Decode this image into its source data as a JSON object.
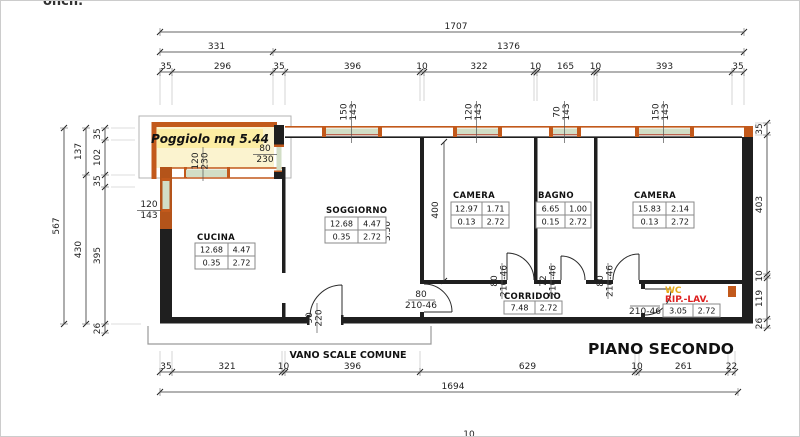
{
  "meta": {
    "clipped_top_text": "onch.",
    "clipped_bottom_text": "10"
  },
  "titles": {
    "balcony": "Poggiolo mq 5.44",
    "stairwell": "VANO SCALE COMUNE",
    "floor": "PIANO SECONDO"
  },
  "dims": {
    "top_total": "1707",
    "top_mid": [
      "331",
      "1376"
    ],
    "top_row3": [
      "35",
      "296",
      "35",
      "396",
      "10",
      "322",
      "10",
      "165",
      "10",
      "393",
      "35"
    ],
    "bottom_row": [
      "35",
      "321",
      "10",
      "396",
      "629",
      "10",
      "261",
      "22"
    ],
    "bottom_total": "1694",
    "left_total": "567",
    "left_mid": [
      "137",
      "430"
    ],
    "left_inner": [
      "35",
      "102",
      "35",
      "395",
      "26"
    ],
    "right": [
      "35",
      "403",
      "10",
      "119",
      "26"
    ],
    "camera_depth": "400",
    "soggiorno_side": "3.50"
  },
  "rooms": {
    "cucina": {
      "name": "CUCINA",
      "table": [
        [
          "12.68",
          "4.47"
        ],
        [
          "0.35",
          "2.72"
        ]
      ]
    },
    "soggiorno": {
      "name": "SOGGIORNO",
      "table": [
        [
          "12.68",
          "4.47"
        ],
        [
          "0.35",
          "2.72"
        ]
      ]
    },
    "camera1": {
      "name": "CAMERA",
      "table": [
        [
          "12.97",
          "1.71"
        ],
        [
          "0.13",
          "2.72"
        ]
      ]
    },
    "bagno": {
      "name": "BAGNO",
      "table": [
        [
          "6.65",
          "1.00"
        ],
        [
          "0.15",
          "2.72"
        ]
      ]
    },
    "camera2": {
      "name": "CAMERA",
      "table": [
        [
          "15.83",
          "2.14"
        ],
        [
          "0.13",
          "2.72"
        ]
      ]
    },
    "corridoio": {
      "name": "CORRIDOIO",
      "table": [
        [
          "7.48",
          "2.72"
        ]
      ]
    },
    "wc": {
      "name_line1": "WC",
      "name_line2": "RIP.-LAV.",
      "table": [
        [
          "3.05",
          "2.72"
        ]
      ]
    }
  },
  "openings": {
    "balcony_door": {
      "w": "120",
      "h": "230"
    },
    "balcony_side": {
      "w": "80",
      "h": "230"
    },
    "left_window": {
      "w": "120",
      "h": "143"
    },
    "win_soggiorno": {
      "w": "150",
      "h": "143"
    },
    "win_camera1": {
      "w": "120",
      "h": "143"
    },
    "win_bagno": {
      "w": "70",
      "h": "143"
    },
    "win_camera2": {
      "w": "150",
      "h": "143"
    },
    "door_soggiorno": {
      "w": "80",
      "h": "210-46"
    },
    "door_camera1": {
      "w": "80",
      "h": "210-46"
    },
    "door_bagno": {
      "w": "72",
      "h": "210-46"
    },
    "door_camera2": {
      "w": "80",
      "h": "210-46"
    },
    "door_wc": {
      "h": "210-46"
    },
    "door_entry": {
      "w": "90",
      "h": "220"
    }
  },
  "colors": {
    "wall_black": "#1f1f1f",
    "wall_orange": "#c2591b",
    "balcony_fill": "#fbf3cf",
    "highlight_yellow": "#fceda3",
    "window_green": "#d2dec6",
    "window_red_line": "#b23c2a",
    "wc_label": "#e6a817",
    "rip_label": "#dd1f1f"
  }
}
